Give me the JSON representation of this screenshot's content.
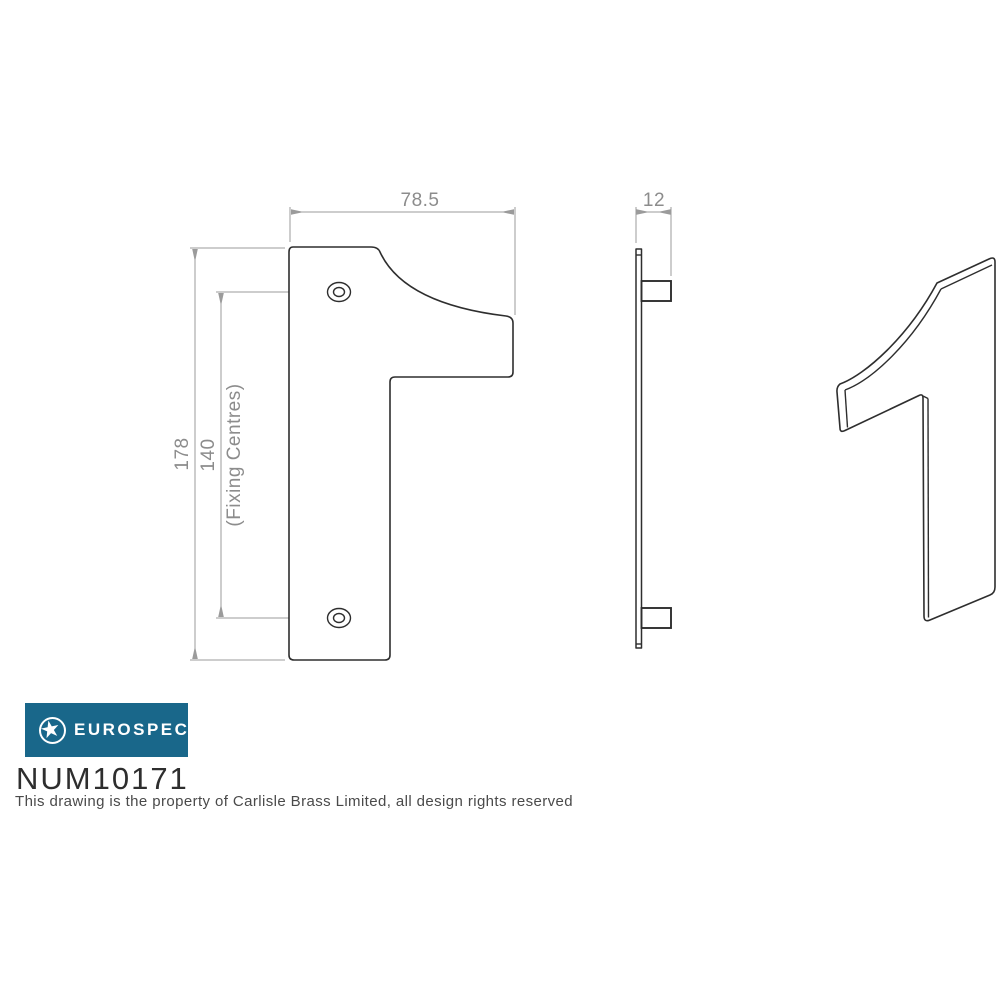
{
  "colors": {
    "brand_teal": "#19678a",
    "part_outline": "#2e2e2e",
    "dimension_gray": "#8c8c8c"
  },
  "front_view": {
    "width_label": "78.5",
    "height_label": "178",
    "fixing_centres_value": "140",
    "fixing_centres_label": "(Fixing Centres)"
  },
  "side_view": {
    "thickness_label": "12"
  },
  "logo": {
    "brand": "EUROSPEC",
    "icon": "star-in-circle"
  },
  "part_number": "NUM10171",
  "disclaimer": "This drawing is the property of Carlisle Brass Limited, all design rights reserved"
}
